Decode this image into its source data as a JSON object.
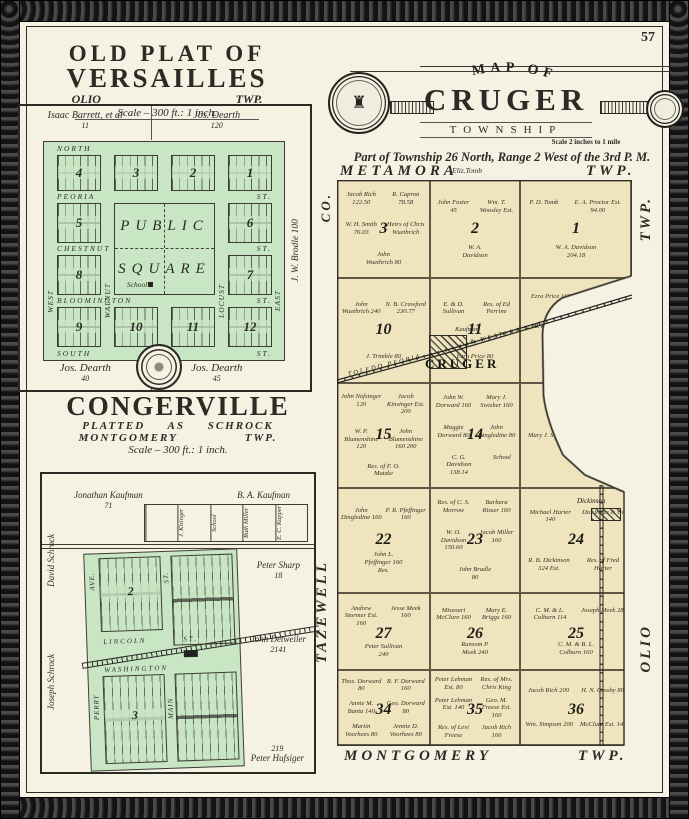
{
  "page": {
    "number": "57"
  },
  "colors": {
    "paper": "#f5f1e3",
    "plat_green": "#c9e6c4",
    "map_tan": "#f0e4bf",
    "ink": "#2b2b26",
    "border_band": "#161616"
  },
  "versailles": {
    "title_line1": "OLD PLAT OF",
    "title_line2": "VERSAILLES",
    "sub_left": "OLIO",
    "sub_right": "TWP.",
    "scale": "Scale – 300 ft.: 1 inch.",
    "owner_top_left": "Isaac Barrett, et al",
    "owner_top_left_acres": "11",
    "owner_top_right": "Jos. Dearth",
    "owner_top_right_acres": "120",
    "owner_right": "J. W. Brodle  100",
    "owner_bottom_left": "Jos. Dearth",
    "owner_bottom_left_acres": "40",
    "owner_bottom_right": "Jos. Dearth",
    "owner_bottom_right_acres": "45",
    "square_word1": "PUBLIC",
    "square_word2": "SQUARE",
    "school": "School",
    "streets": {
      "north": "NORTH",
      "peoria": "PEORIA",
      "chestnut": "CHESTNUT",
      "bloomington": "BLOOMINGTON",
      "south": "SOUTH",
      "west": "WEST",
      "walnut": "WALNUT",
      "locust": "LOCUST",
      "east": "EAST",
      "st": "ST."
    },
    "blocks": [
      "4",
      "3",
      "2",
      "1",
      "5",
      "6",
      "8",
      "7",
      "9",
      "10",
      "11",
      "12"
    ]
  },
  "congerville": {
    "title": "CONGERVILLE",
    "sub1": "PLATTED AS SCHROCK",
    "sub2_left": "MONTGOMERY",
    "sub2_right": "TWP.",
    "scale": "Scale – 300 ft.: 1 inch.",
    "owner_nw": "Jonathan Kaufman",
    "owner_nw_acres": "71",
    "owner_ne": "B. A. Kaufman",
    "parcel_boxes": [
      "",
      "J. Kisinger",
      "School",
      "Ruth Miller",
      "E. C. Kupper"
    ],
    "owner_e1": "Peter Sharp",
    "owner_e1_acres": "18",
    "owner_e2": "John Detweiler",
    "owner_e2_acres": "2141",
    "owner_se": "Peter Hufsiger",
    "owner_se_acres": "219",
    "owner_w1": "David Schrock",
    "owner_w2": "Joseph Schrock",
    "streets": {
      "lincoln": "LINCOLN",
      "washington": "WASHINGTON",
      "main": "MAIN",
      "perry": "PERRY",
      "ave": "AVE.",
      "st": "ST."
    },
    "blocks": [
      "2",
      "3"
    ]
  },
  "cruger": {
    "map_of": "MAP OF",
    "name": "CRUGER",
    "township_word": "TOWNSHIP",
    "scale": "Scale 2 inches to 1 mile",
    "legal": "Part of Township 26 North, Range 2 West of the 3rd P. M.",
    "north_label": "METAMORA",
    "north_right": "TWP.",
    "eliz_tomb": "Eliz.Tomb",
    "west_top": "CO.",
    "west_bottom": "TAZEWELL",
    "south_label": "MONTGOMERY",
    "south_right": "TWP.",
    "east_top": "TWP.",
    "east_bottom": "OLIO",
    "town": "CRUGER",
    "town_kaufman": "Kaufman",
    "town2": "Dickinson",
    "railroad_w": "TOLEDO  PEORIA",
    "railroad_e": "& WESTERN  R.R.",
    "sections": [
      {
        "num": "3",
        "parcels": [
          "Jacob Rich 122.50",
          "R. Capron 78.58",
          "W. H. Smith 76.03",
          "Heirs of Chris Wuethrich",
          "John Wuethrich 80"
        ]
      },
      {
        "num": "2",
        "parcels": [
          "John Foster 45",
          "Wm. T. Woosley Est.",
          "W. A. Davidson"
        ]
      },
      {
        "num": "1",
        "parcels": [
          "P. D. Tomb",
          "E. A. Proctor Est. 94.00",
          "W. A. Davidson 204.18"
        ]
      },
      {
        "num": "10",
        "parcels": [
          "John Wuethrich 240",
          "N. B. Crawford 230.77",
          "J. Trimble 80"
        ]
      },
      {
        "num": "11",
        "parcels": [
          "E. & D. Sullivan",
          "Res. of Ed Perrine",
          "Ezra Price 80"
        ]
      },
      {
        "num": "12",
        "parcels": [
          "Ezra Price 160",
          "E. S. Combe",
          "W. P. Simpson",
          "P. E. Lowe",
          "R. F. Dorward 74.67"
        ]
      },
      {
        "num": "15",
        "parcels": [
          "John Nofsinger 120",
          "Jacob Kinsinger Est. 200",
          "W. P. Blumenshine 120",
          "John Blumenshine 160 200",
          "Res. of F. O. Matzke"
        ]
      },
      {
        "num": "14",
        "parcels": [
          "John W. Dorward 160",
          "Mary J. Swisher 160",
          "Maggie Dorward 80",
          "John Dingledine 80",
          "C. G. Davidson 138.14",
          "School"
        ]
      },
      {
        "num": "13",
        "parcels": [
          "Mary J. Swisher",
          "C. G. Davidson"
        ]
      },
      {
        "num": "22",
        "parcels": [
          "John Dingledine 160",
          "P. R. Pfeffinger 160",
          "John L. Pfeffinger 160 Res."
        ]
      },
      {
        "num": "23",
        "parcels": [
          "Res. of C. S. Morrow",
          "Barbara Risser 160",
          "W. O. Davidson 150.60",
          "Jacob Miller 160",
          "John Bradle 80"
        ]
      },
      {
        "num": "24",
        "parcels": [
          "Michael Harter 140",
          "Dickinson & Co.",
          "R. B. Dickinson 324 Est.",
          "Res. of Fred Harter"
        ]
      },
      {
        "num": "27",
        "parcels": [
          "Andrew Stormer Est. 160",
          "Jesse Meek 160",
          "Peter Sullivan 240"
        ]
      },
      {
        "num": "26",
        "parcels": [
          "Missouri McClure 160",
          "Mary E. Briggs 160",
          "Ransom P. Meek 240"
        ]
      },
      {
        "num": "25",
        "parcels": [
          "C. M. & L. Colburn 114",
          "Joseph Meek 284",
          "C. M. & B. L. Colburn 160"
        ]
      },
      {
        "num": "34",
        "parcels": [
          "Thos. Dorward 80",
          "R. F. Dorward 160",
          "Annie M. Banta 140",
          "Geo. Dorward 80",
          "Martin Voorhees 80",
          "Jennie D. Voorhees 80"
        ]
      },
      {
        "num": "35",
        "parcels": [
          "Peter Lehman Est. 80",
          "Res. of Mrs. Chris King",
          "Peter Lehman Est. 140",
          "Geo. M. Freese Est. 160",
          "Res. of Levi Freese",
          "Jacob Rich 160"
        ]
      },
      {
        "num": "36",
        "parcels": [
          "Jacob Rich 200",
          "H. N. Crosby 80",
          "Wm. Simpson 200",
          "McClure Est. 140"
        ]
      }
    ]
  }
}
